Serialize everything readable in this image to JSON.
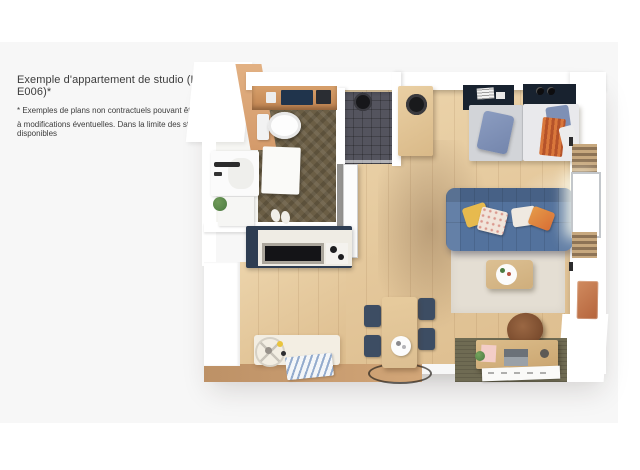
{
  "page": {
    "caption": {
      "title": "Exemple d'appartement de studio (Lot E006)*",
      "disclaimer_line1": "* Exemples de plans non contractuels pouvant être soumis",
      "disclaimer_line2": "à modifications éventuelles. Dans la limite des stocks disponibles"
    }
  },
  "colors": {
    "page_bg": "#ffffff",
    "card_bg": "#f7f7f7",
    "text": "#3c3c3c",
    "wall_white": "#ffffff",
    "wall_tan": "#d49a6a",
    "floor_wood_light": "#ecd4ab",
    "floor_wood_dark": "#ddbd8e",
    "floor_bath": "#6b5e45",
    "floor_shower": "#54545e",
    "kitchen_navy": "#2e3d52",
    "counter_white": "#efece4",
    "cooktop_black": "#141417",
    "sofa_blue": "#53729d",
    "rug_beige": "#e4ded3",
    "rug_olive": "#6f6b53",
    "headboard_navy": "#18222f",
    "mattress_gray": "#d2d4d8",
    "mattress_white": "#e9e9ec",
    "pillow_blue": "#7486ad",
    "pillow_yellow": "#e7ba4e",
    "pillow_orange": "#d96f35",
    "chair_navy": "#3d4d63",
    "table_wood": "#dcbf92",
    "bench_cream": "#f3eee3",
    "doormat_blue": "#4a6eaa",
    "bottom_wall_tan": "#d2a678",
    "artwork_terracotta": "#b5643c",
    "desk_wood": "#caa570",
    "chair_brown": "#6f4226",
    "plant_green": "#4c7a42"
  }
}
